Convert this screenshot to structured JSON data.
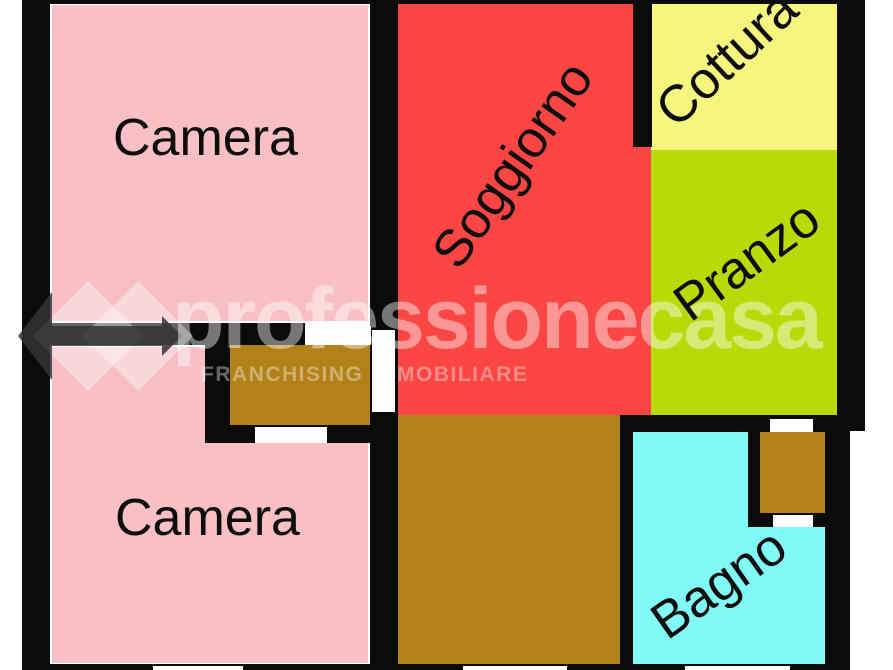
{
  "image_type": "floor_plan",
  "watermark": {
    "brand": "professionecasa",
    "tagline": "FRANCHISING IMMOBILIARE"
  },
  "floorplan": {
    "rooms": [
      {
        "id": "camera-top",
        "label": "Camera",
        "color": "#f8c0c5"
      },
      {
        "id": "soggiorno",
        "label": "Soggiorno",
        "color": "#fb4643"
      },
      {
        "id": "cottura",
        "label": "Cottura",
        "color": "#f6f67e"
      },
      {
        "id": "pranzo",
        "label": "Pranzo",
        "color": "#b8da09"
      },
      {
        "id": "camera-bottom",
        "label": "Camera",
        "color": "#f8c0c5"
      },
      {
        "id": "bagno",
        "label": "Bagno",
        "color": "#80fbf7"
      }
    ],
    "unlabeled_areas": [
      {
        "id": "corridor-upper",
        "color": "#b28118"
      },
      {
        "id": "corridor-main",
        "color": "#b28118"
      },
      {
        "id": "shaft-box",
        "color": "#b28118"
      }
    ],
    "wall_color": "#0b0b0b",
    "door_color": "#ffffff",
    "background_color": "#ffffff"
  }
}
